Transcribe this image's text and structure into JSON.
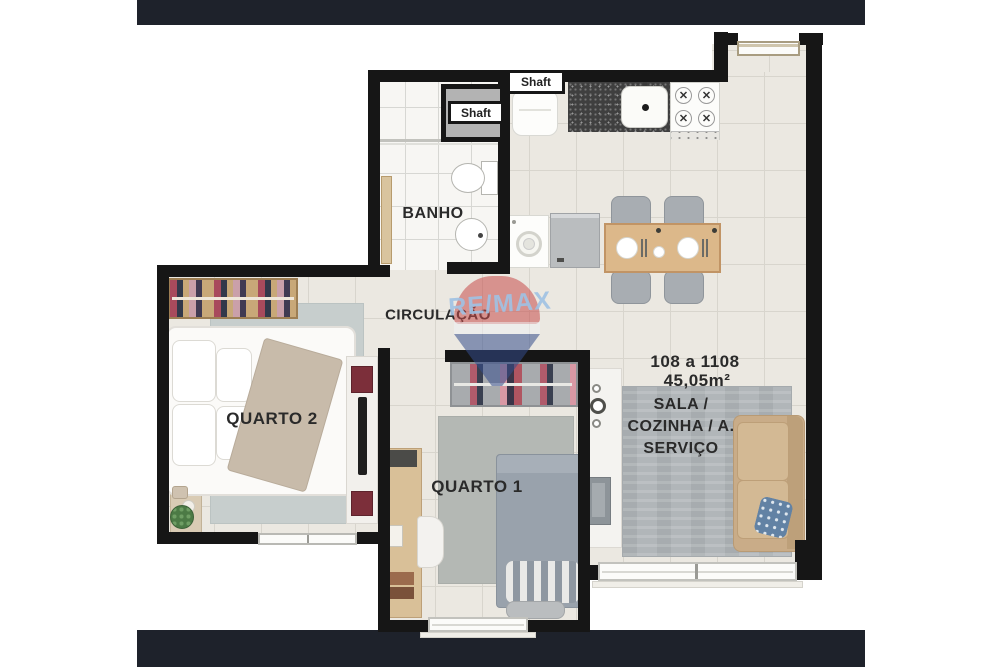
{
  "plan": {
    "title_labels": {
      "banho": "BANHO",
      "circulacao": "CIRCULAÇÃO",
      "quarto2": "QUARTO 2",
      "quarto1": "QUARTO 1",
      "unit_range": "108 a 1108",
      "unit_area": "45,05m²",
      "sala_line1": "SALA /",
      "sala_line2": "COZINHA / A.",
      "sala_line3": "SERVIÇO",
      "shaft_bath": "Shaft",
      "shaft_kitchen": "Shaft"
    },
    "watermark": {
      "brand_text": "RE/MAX",
      "text_color": "#9fc1e3",
      "balloon_red": "#c64a4a",
      "balloon_blue": "#32498c"
    },
    "colors": {
      "letterbox_bar": "#1e222b",
      "wall": "#161616",
      "floor_tile": "#ebe8e1",
      "bath_tile": "#f7f6f3",
      "wood": "#d9b98c",
      "rug_gray": "#b4b8b4",
      "sofa_beige": "#c9ac88",
      "counter_granite": "#3f3f3f",
      "label_text": "#2a2a2a"
    },
    "icons": {
      "burner_glyph": "✕"
    }
  }
}
